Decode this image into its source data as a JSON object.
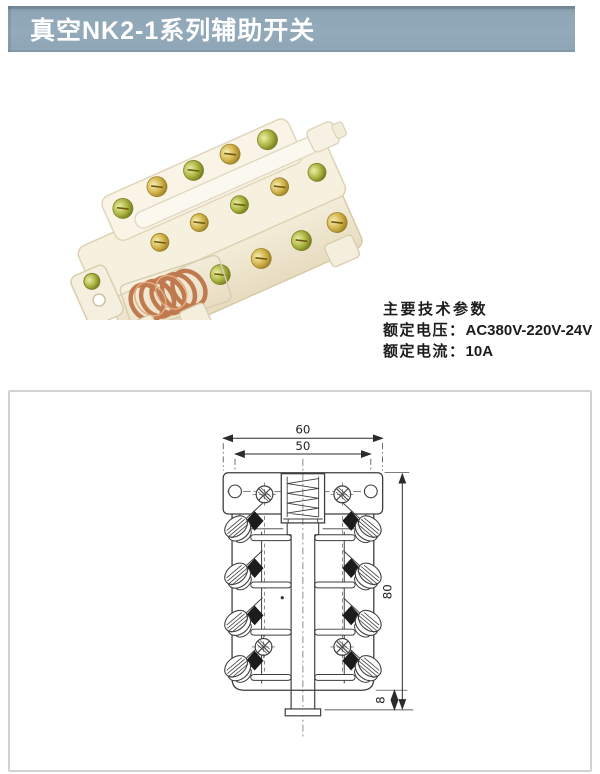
{
  "header": {
    "title": "真空NK2-1系列辅助开关"
  },
  "specs": {
    "heading": "主要技术参数",
    "items": [
      {
        "label": "额定电压：",
        "value": "AC380V-220V-24V"
      },
      {
        "label": "额定电流：",
        "value": "10A"
      }
    ]
  },
  "drawing": {
    "dim_top_outer": "60",
    "dim_top_inner": "50",
    "dim_height": "80",
    "dim_foot": "8"
  },
  "colors": {
    "banner_bg": "#93aaba",
    "banner_text": "#ffffff",
    "drawing_line": "#3d3d3d",
    "panel_border": "#d2d2d2",
    "photo_body": "#f5efdf",
    "photo_brass": "#c9a43c",
    "photo_copper": "#c07a50"
  }
}
